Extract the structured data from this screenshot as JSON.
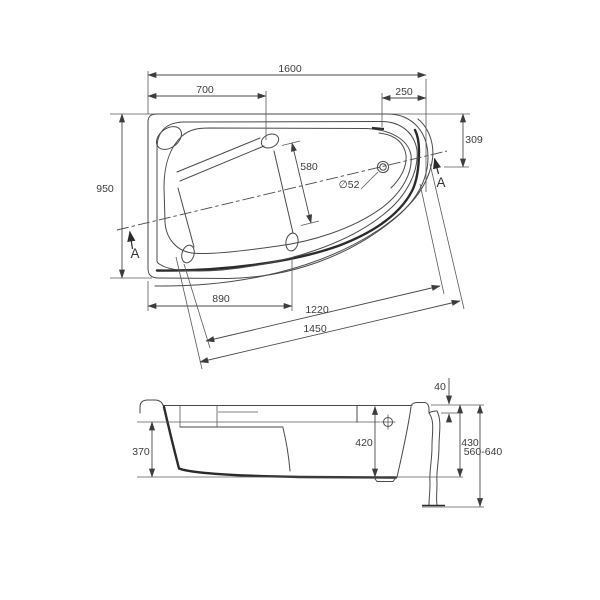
{
  "top_view": {
    "overall_length": "1600",
    "head_section_length": "700",
    "drain_edge_offset": "250",
    "drain_top_offset": "309",
    "overall_width": "950",
    "lying_surface_width": "580",
    "drain_diameter": "∅52",
    "foot_edge_length": "890",
    "front_edge_inner": "1220",
    "front_edge_outer": "1450",
    "section_marker_left": "A",
    "section_marker_right": "A"
  },
  "side_view": {
    "rim_flange_height": "40",
    "inner_depth": "370",
    "depth_at_overflow": "420",
    "shell_height": "430",
    "installed_height_range": "560-640"
  }
}
